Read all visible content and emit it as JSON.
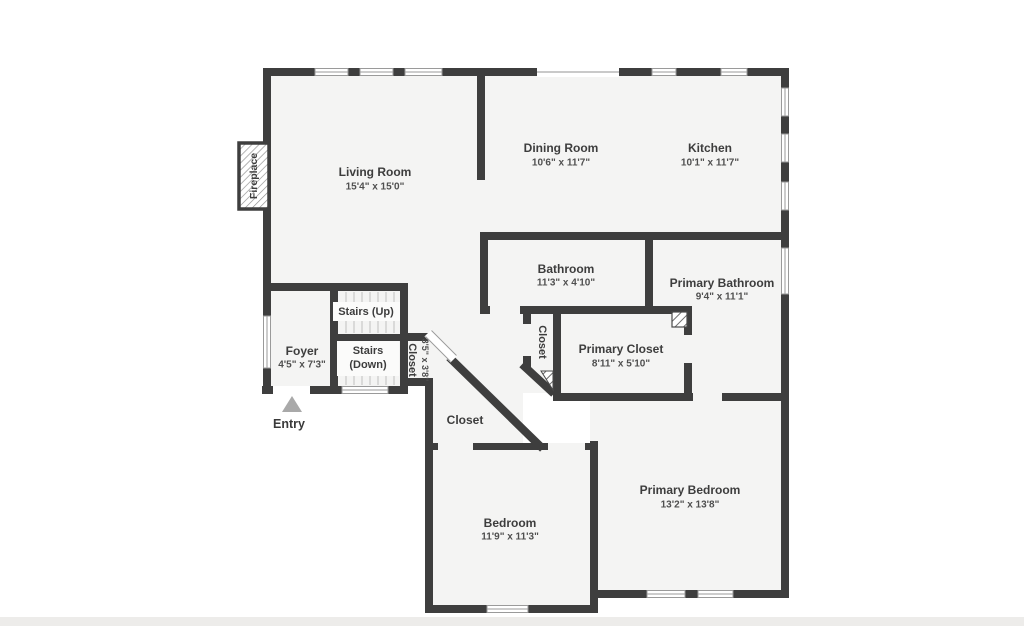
{
  "plan": {
    "wall_color": "#3e3e3e",
    "floor_color": "#f4f4f3",
    "entry_arrow_color": "#a9a9a9"
  },
  "rooms": {
    "living_room": {
      "name": "Living Room",
      "dims": "15'4\" x 15'0\""
    },
    "dining_room": {
      "name": "Dining Room",
      "dims": "10'6\" x 11'7\""
    },
    "kitchen": {
      "name": "Kitchen",
      "dims": "10'1\" x 11'7\""
    },
    "bathroom": {
      "name": "Bathroom",
      "dims": "11'3\" x 4'10\""
    },
    "primary_bathroom": {
      "name": "Primary Bathroom",
      "dims": "9'4\" x 11'1\""
    },
    "primary_closet": {
      "name": "Primary Closet",
      "dims": "8'11\" x 5'10\""
    },
    "closet_hall": {
      "name": "Closet",
      "dims": "3'5\" x 3'8\""
    },
    "closet_mid": {
      "name": "Closet"
    },
    "closet_bedroom": {
      "name": "Closet"
    },
    "bedroom": {
      "name": "Bedroom",
      "dims": "11'9\" x 11'3\""
    },
    "primary_bedroom": {
      "name": "Primary Bedroom",
      "dims": "13'2\" x 13'8\""
    },
    "foyer": {
      "name": "Foyer",
      "dims": "4'5\" x 7'3\""
    },
    "stairs_up": {
      "name": "Stairs (Up)"
    },
    "stairs_down_line1": "Stairs",
    "stairs_down_line2": "(Down)"
  },
  "annotations": {
    "entry": "Entry",
    "fireplace": "Fireplace"
  }
}
